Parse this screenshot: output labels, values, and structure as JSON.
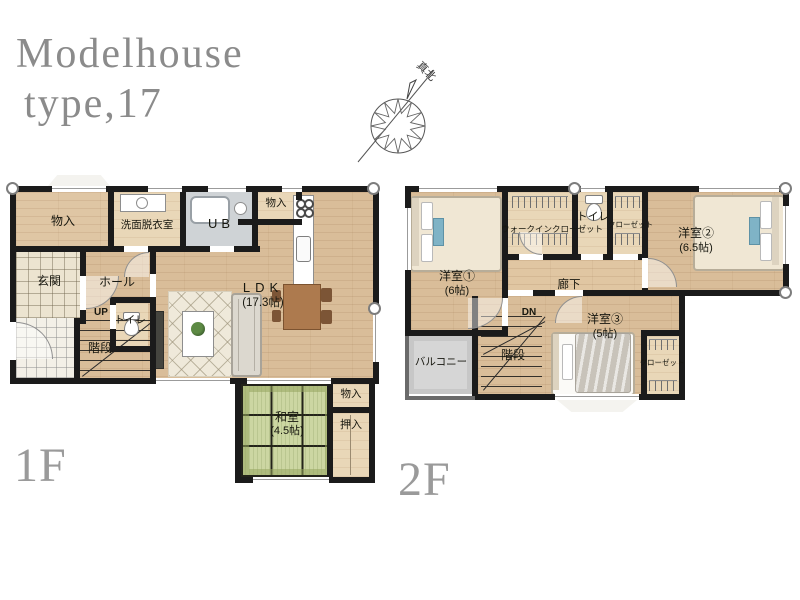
{
  "title": {
    "line1": "Modelhouse",
    "line2": "type,17"
  },
  "compass": {
    "north_label": "真北"
  },
  "floor1": {
    "floor_label": "1F",
    "storage_nw": "物入",
    "washroom": "洗面脱衣室",
    "unit_bath": "UB",
    "storage_top": "物入",
    "entrance": "玄関",
    "hall": "ホール",
    "up": "UP",
    "stairs": "階段",
    "toilet": "トイレ",
    "ldk_name": "LDK",
    "ldk_size": "(17.3帖)",
    "tatami_name": "和室",
    "tatami_size": "(4.5帖)",
    "storage_se": "物入",
    "closet_oshiire": "押入"
  },
  "floor2": {
    "floor_label": "2F",
    "bedroom1_name": "洋室①",
    "bedroom1_size": "(6帖)",
    "walk_in_closet": "ウォークインクローゼット",
    "toilet": "トイレ",
    "closet_top": "クローゼット",
    "bedroom2_name": "洋室②",
    "bedroom2_size": "(6.5帖)",
    "corridor": "廊下",
    "dn": "DN",
    "stairs": "階段",
    "balcony": "バルコニー",
    "bedroom3_name": "洋室③",
    "bedroom3_size": "(5帖)",
    "closet_se": "クローゼット"
  },
  "colors": {
    "wall": "#1b1b1b",
    "wood_floor": "#d9bd99",
    "tatami": "#ccd6a2",
    "balcony": "#d6d6d6",
    "title_gray": "#8b8b8b"
  }
}
